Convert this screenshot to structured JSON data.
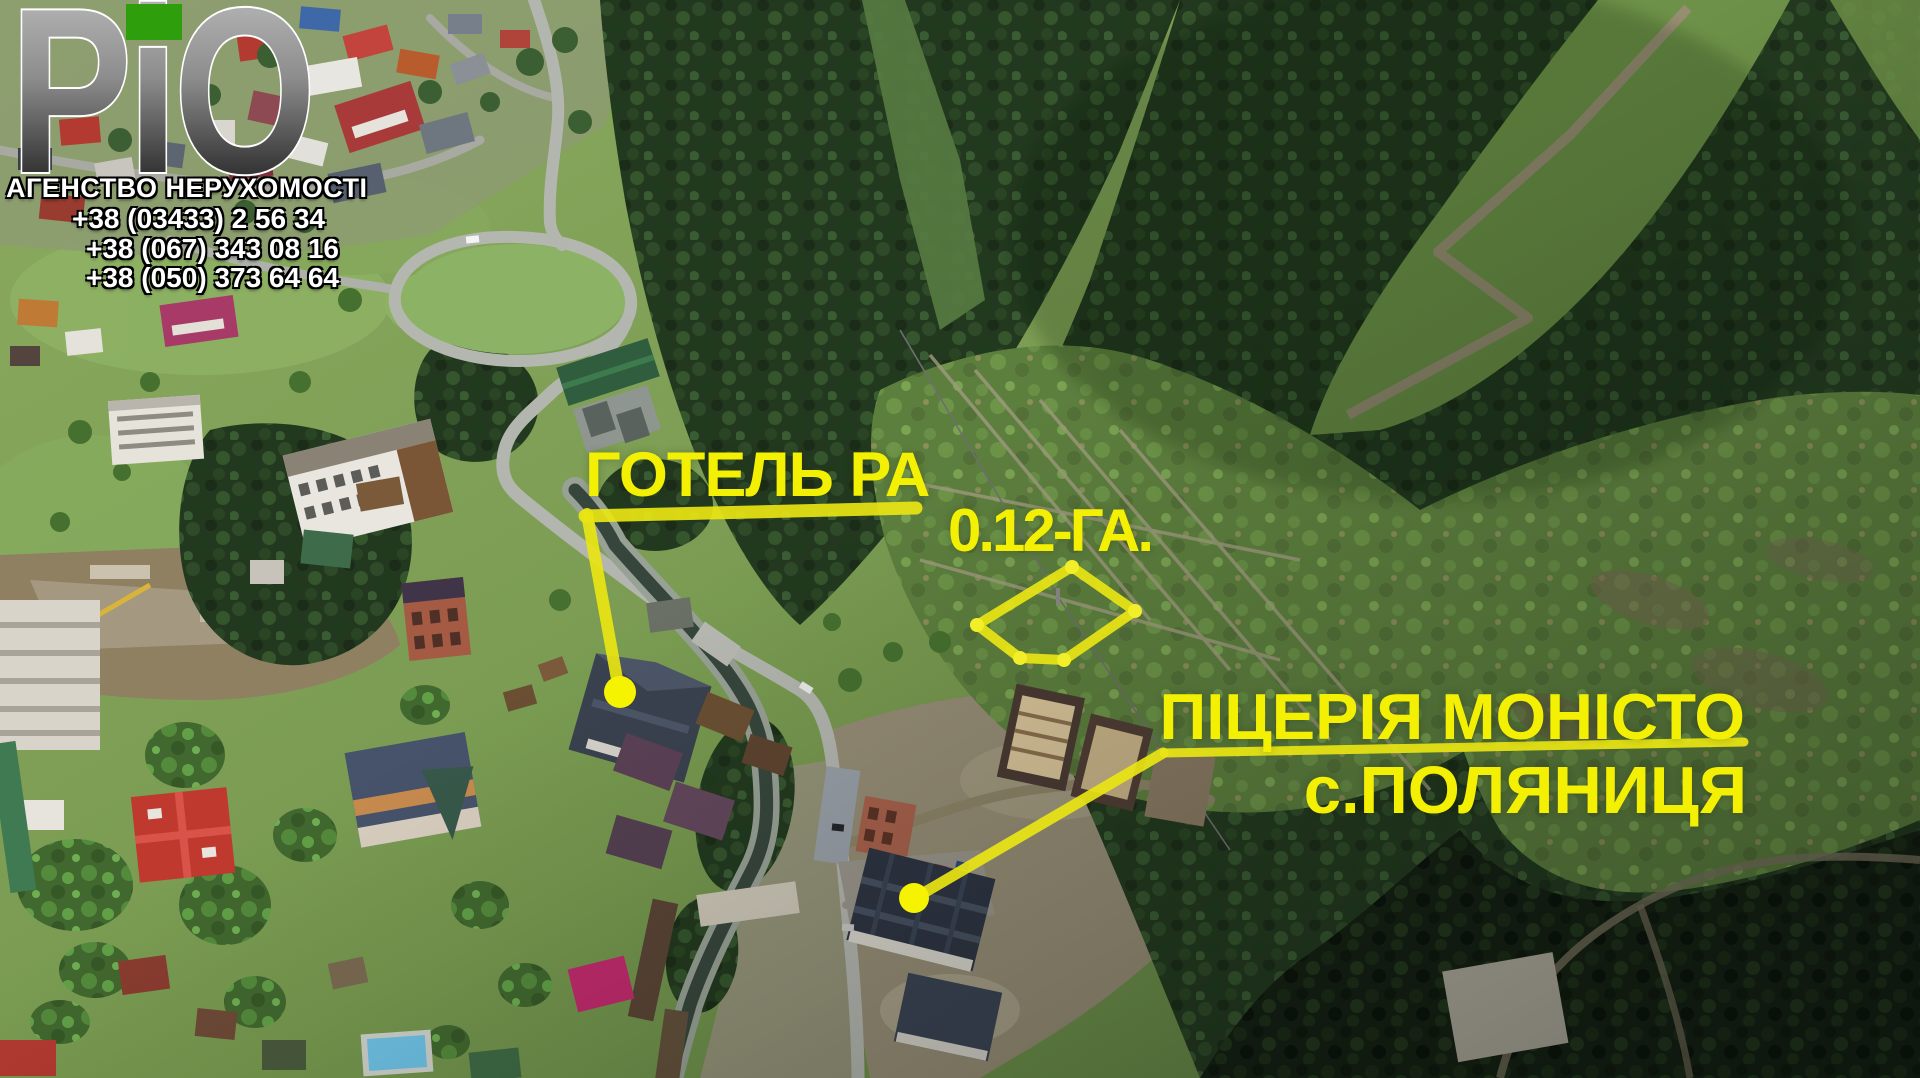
{
  "logo": {
    "text": "РіО",
    "tagline": "АГЕНСТВО НЕРУХОМОСТІ",
    "phones": [
      "+38 (03433) 2 56 34",
      "+38 (067) 343 08 16",
      "+38 (050) 373 64 64"
    ]
  },
  "annotations": {
    "hotel": {
      "label": "ГОТЕЛЬ РА"
    },
    "plot": {
      "label": "0.12-ГА."
    },
    "pizzeria": {
      "label": "ПІЦЕРІЯ МОНІСТО",
      "village": "с.ПОЛЯНИЦЯ"
    }
  },
  "colors": {
    "annotation_text": "#f4f004",
    "annotation_line": "#e9e513",
    "marker_dot": "#f6f300",
    "logo_green": "#2f9e0d"
  }
}
